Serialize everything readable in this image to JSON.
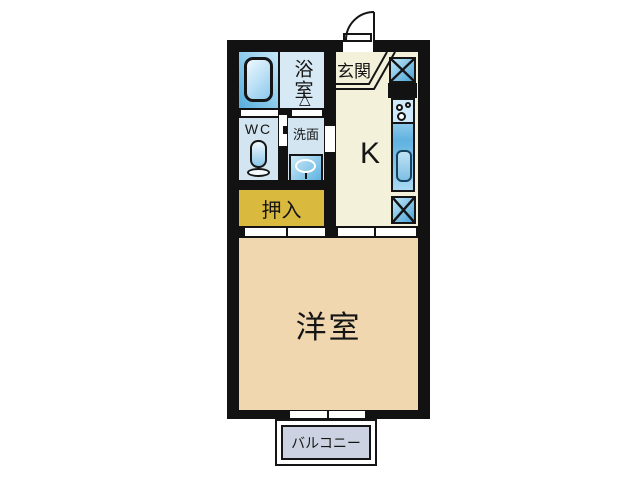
{
  "rooms": {
    "bathroom": "浴室",
    "entrance": "玄関",
    "wc": "WC",
    "washroom": "洗面",
    "kitchen": "K",
    "closet": "押入",
    "western_room": "洋室",
    "balcony": "バルコニー"
  },
  "colors": {
    "wall": "#121212",
    "kitchen_floor": "#f3f1da",
    "western_room_floor": "#f1d7af",
    "closet_fill": "#d9ba3e",
    "wet_area_fill": "#d3e5f1",
    "bath_zone_fill": "#a8d8f0",
    "balcony_fill": "#ccd2e1",
    "fixture_blue_light": "#bfe6f8",
    "fixture_blue_dark": "#4aa3d6",
    "background": "#ffffff"
  },
  "icons": {
    "bathtub": "bathtub-icon",
    "toilet": "toilet-icon",
    "washbasin": "washbasin-icon",
    "stove": "stove-icon",
    "kitchen_sink": "kitchen-sink-icon",
    "shoe_cabinet": "shoe-cabinet-x-icon",
    "refrigerator_space": "refrigerator-x-icon",
    "entry_door": "entry-door-arc-icon",
    "folding_door": "folding-door-triangle-icon"
  }
}
